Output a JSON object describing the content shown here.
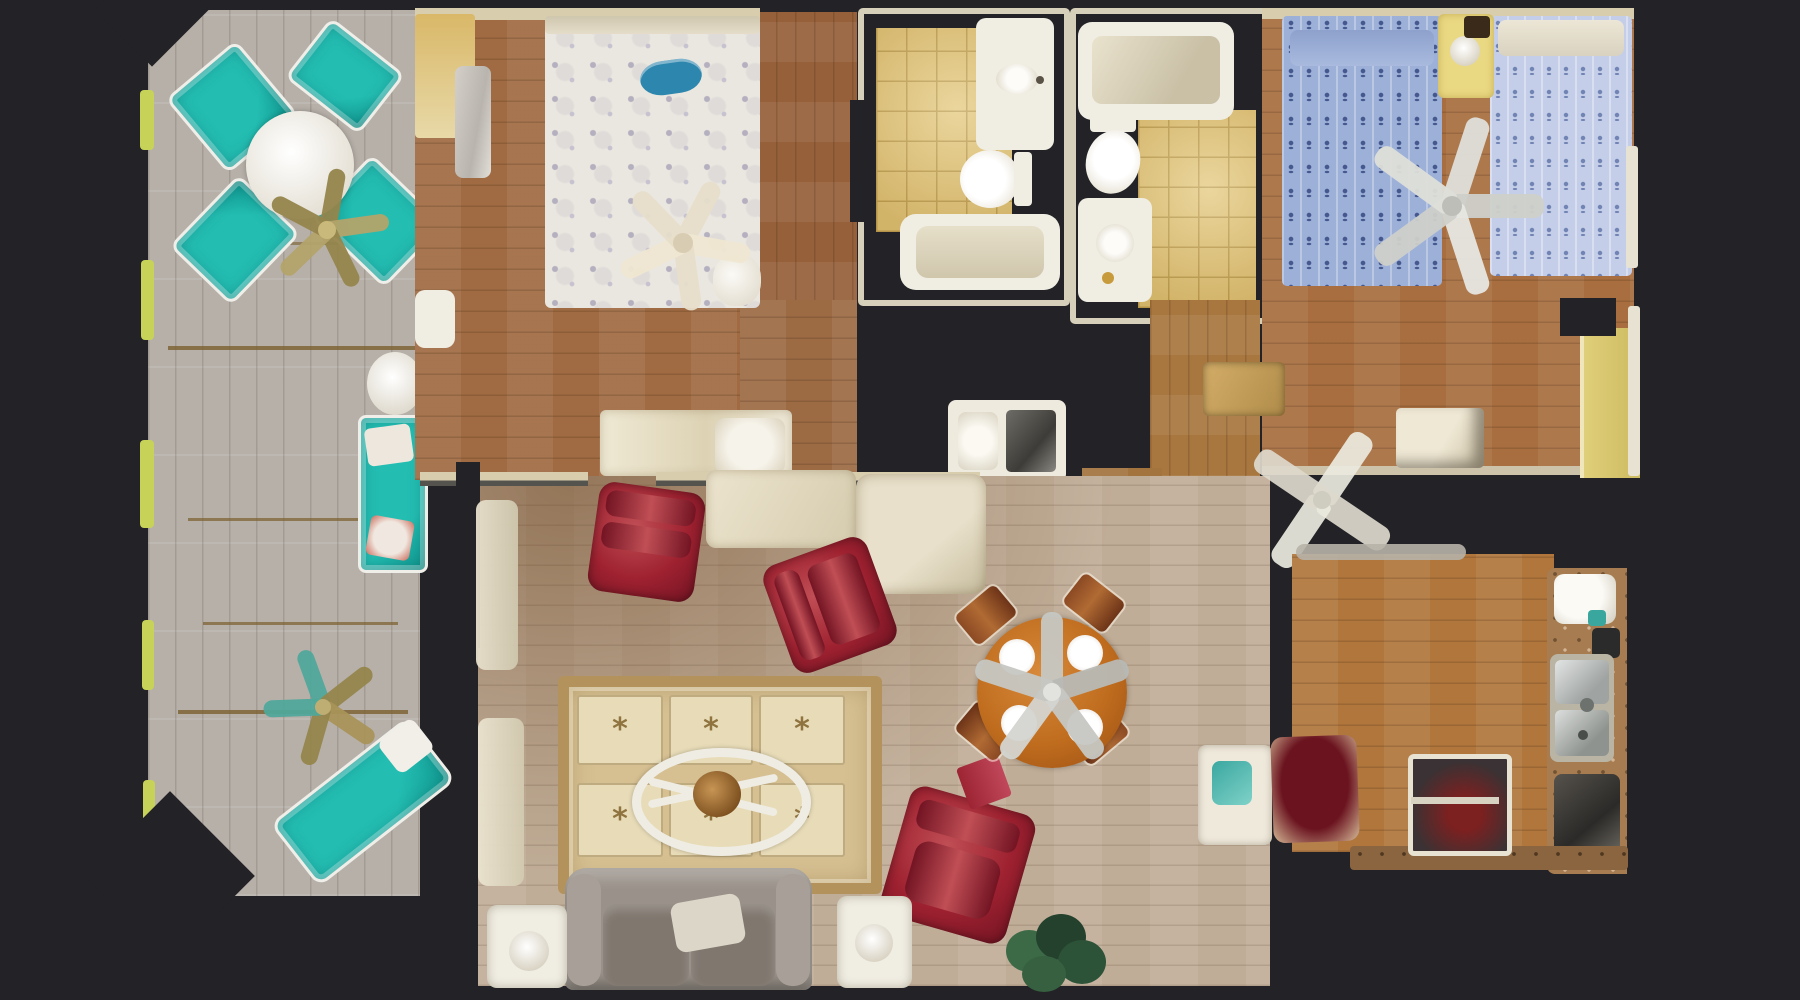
{
  "meta": {
    "view": "top-down dollhouse 3D scan floor plan",
    "background_note": "dark charcoal canvas around scanned rooms"
  },
  "icons": {
    "palm_motif": "*"
  },
  "palette": {
    "bg": "#232327",
    "deck": "#b7b0a9",
    "deckGap": "#7a5f2e",
    "porchEdge": "#c6d258",
    "teal": "#23bdb2",
    "tealDark": "#0f968e",
    "fanOlive": "#95854c",
    "fanTeal": "#4fa89a",
    "woodBedroom": "#a06b42",
    "woodKids": "#a86e40",
    "woodHall": "#a8763f",
    "woodLiving": "#c0ad97",
    "woodLivingDark": "#9b7a54",
    "woodKitchen": "#b0763c",
    "bedWhite": "#eae7e0",
    "starGray": "#b5b0bf",
    "boatTeal": "#2d86ad",
    "fanCream": "#e7deca",
    "consoleCream": "#e7dec6",
    "tile": "#e4c87c",
    "tileLine": "#bfa052",
    "fixture": "#f0ede3",
    "fixtureShade": "#d6cfba",
    "wallCream": "#d8cead",
    "bedBlueA": "#9db0d8",
    "anchorA": "#46598f",
    "bedBlueB": "#c4cee8",
    "anchorB": "#7284b4",
    "nightstandYellow": "#ead983",
    "redChair": "#9e2130",
    "redChairDark": "#731423",
    "redChairHi": "#c04e55",
    "rugBase": "#d6c092",
    "rugBorder": "#b3925c",
    "rugPanel": "#e8dcb8",
    "rugMotif": "#8f7440",
    "bookRed": "#9c2433",
    "bronze": "#a87b3a",
    "couch": "#9a928a",
    "couchDark": "#80786f",
    "couchArm": "#a8a098",
    "pillowCream": "#dcd6c8",
    "tableWhite": "#efece4",
    "plantDark": "#24412e",
    "plantMid": "#3c6a46",
    "dineWood": "#bf6c1e",
    "chairCopper": "#8c4a24",
    "fanSilver": "#c6c7c3",
    "fanWhite": "#eceadf",
    "counter": "#a67c50",
    "counterDark": "#8a6540",
    "steel": "#c2c5c4",
    "darkItem": "#2b2b2b",
    "maroon": "#6b1420",
    "doorYellow": "#e0cf7a"
  },
  "scene": {
    "porch": {
      "name": "screened porch deck",
      "furniture": [
        "round patio table",
        "four teal patio chairs",
        "two ceiling fans",
        "white side table",
        "teal loveseat",
        "teal chaise lounge"
      ]
    },
    "master_bedroom": {
      "name": "master bedroom",
      "furniture": [
        "queen bed with starfish quilt",
        "teal boat pillow",
        "cream ceiling fan",
        "cream credenza",
        "nightstand"
      ]
    },
    "bathroom_1": {
      "name": "hall bathroom",
      "furniture": [
        "vanity sink",
        "toilet",
        "bathtub"
      ],
      "floor": "yellow tile"
    },
    "bathroom_2": {
      "name": "second bathroom",
      "furniture": [
        "bathtub",
        "toilet",
        "vanity sink"
      ],
      "floor": "yellow tile"
    },
    "kids_bedroom": {
      "name": "bedroom with twin beds",
      "furniture": [
        "twin bed anchor quilt dark",
        "twin bed anchor quilt light",
        "yellow nightstand with lamp",
        "ceiling fan",
        "dresser",
        "closet door"
      ]
    },
    "living_room": {
      "name": "living room",
      "furniture": [
        "three burgundy armchairs",
        "palm motif area rug",
        "oval coffee table with red book",
        "gray couch with pillow",
        "two white side tables with lamps",
        "potted plant",
        "round dining table with four plates",
        "four wooden dining chairs",
        "dining ceiling fan",
        "white cabinet with teal towel",
        "console with dark top",
        "white ceiling fan"
      ]
    },
    "kitchen": {
      "name": "kitchen",
      "furniture": [
        "double stainless sink",
        "speckled counter",
        "dark appliances",
        "maroon mat",
        "cabinet with shelf"
      ]
    }
  }
}
